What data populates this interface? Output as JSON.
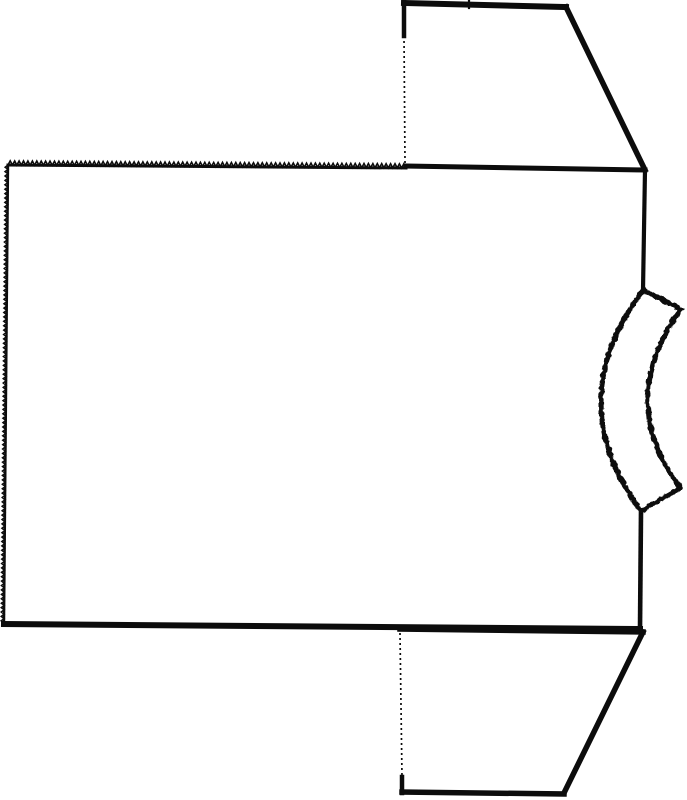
{
  "colors": {
    "ink": "#0c0c0c",
    "paper": "#ffffff"
  },
  "drawing": {
    "canvas": {
      "width": 687,
      "height": 800
    },
    "parts": [
      {
        "name": "body-panel",
        "edges": [
          {
            "name": "body-top-pinked-edge",
            "type": "pinked",
            "from": [
              8,
              165
            ],
            "to": [
              406,
              168
            ],
            "pitch": 4.4,
            "amp": 4.2,
            "base_width": 3.0
          },
          {
            "name": "body-left-pinked-edge",
            "type": "pinked",
            "from": [
              4,
              623
            ],
            "to": [
              8,
              165
            ],
            "pitch": 4.4,
            "amp": 2.8,
            "base_width": 2.4
          },
          {
            "name": "body-bottom-hem",
            "type": "solid",
            "from": [
              4,
              624
            ],
            "to": [
              640,
              629
            ],
            "width": 6
          },
          {
            "name": "body-right-upper-seam",
            "type": "solid",
            "from": [
              645,
              170
            ],
            "to": [
              643,
              290
            ],
            "width": 4.2
          },
          {
            "name": "body-right-lower-seam",
            "type": "solid",
            "from": [
              641,
              511
            ],
            "to": [
              640,
              629
            ],
            "width": 4.6
          }
        ]
      },
      {
        "name": "top-sleeve",
        "edges": [
          {
            "name": "top-sleeve-cuff-edge",
            "type": "solid",
            "from": [
              404,
              3
            ],
            "to": [
              566,
              7
            ],
            "width": 6
          },
          {
            "name": "top-sleeve-underarm-seam",
            "type": "solid",
            "from": [
              566,
              7
            ],
            "to": [
              645,
              170
            ],
            "width": 5.5
          },
          {
            "name": "top-sleeve-shoulder-seam",
            "type": "solid",
            "from": [
              406,
              166
            ],
            "to": [
              645,
              170
            ],
            "width": 5
          },
          {
            "name": "top-sleeve-cuff-side",
            "type": "solid",
            "from": [
              404,
              2
            ],
            "to": [
              404,
              36
            ],
            "width": 4.5
          },
          {
            "name": "top-sleeve-fold-line",
            "type": "dotted",
            "from": [
              404,
              36
            ],
            "to": [
              405,
              163
            ],
            "width": 1.7
          },
          {
            "name": "top-sleeve-notch-mark",
            "type": "solid",
            "from": [
              469,
              1
            ],
            "to": [
              469,
              8
            ],
            "width": 2.2
          }
        ]
      },
      {
        "name": "bottom-sleeve",
        "edges": [
          {
            "name": "bottom-sleeve-shoulder-seam",
            "type": "solid",
            "from": [
              400,
              629
            ],
            "to": [
              643,
              632
            ],
            "width": 5.5
          },
          {
            "name": "bottom-sleeve-underarm-seam",
            "type": "solid",
            "from": [
              643,
              632
            ],
            "to": [
              564,
              793
            ],
            "width": 5.5
          },
          {
            "name": "bottom-sleeve-cuff-edge",
            "type": "solid",
            "from": [
              564,
              794
            ],
            "to": [
              402,
              792
            ],
            "width": 5.5
          },
          {
            "name": "bottom-sleeve-fold-line",
            "type": "dotted",
            "from": [
              400,
              633
            ],
            "to": [
              402,
              777
            ],
            "width": 1.7
          },
          {
            "name": "bottom-sleeve-cuff-side",
            "type": "solid",
            "from": [
              402,
              777
            ],
            "to": [
              402,
              793
            ],
            "width": 4.5
          }
        ]
      },
      {
        "name": "collar-band",
        "rough": true,
        "edges": [
          {
            "name": "collar-inner-curve",
            "type": "rough-quad",
            "from": [
              643,
              290
            ],
            "ctrl": [
              560,
              401
            ],
            "to": [
              641,
              511
            ],
            "width": 5
          },
          {
            "name": "collar-outer-curve",
            "type": "rough-quad",
            "from": [
              681,
              309
            ],
            "ctrl": [
              615,
              400
            ],
            "to": [
              680,
              488
            ],
            "width": 5
          },
          {
            "name": "collar-top-end",
            "type": "rough-line",
            "from": [
              643,
              290
            ],
            "to": [
              681,
              309
            ],
            "width": 5
          },
          {
            "name": "collar-bottom-end",
            "type": "rough-line",
            "from": [
              641,
              511
            ],
            "to": [
              680,
              488
            ],
            "width": 5
          }
        ]
      }
    ]
  }
}
